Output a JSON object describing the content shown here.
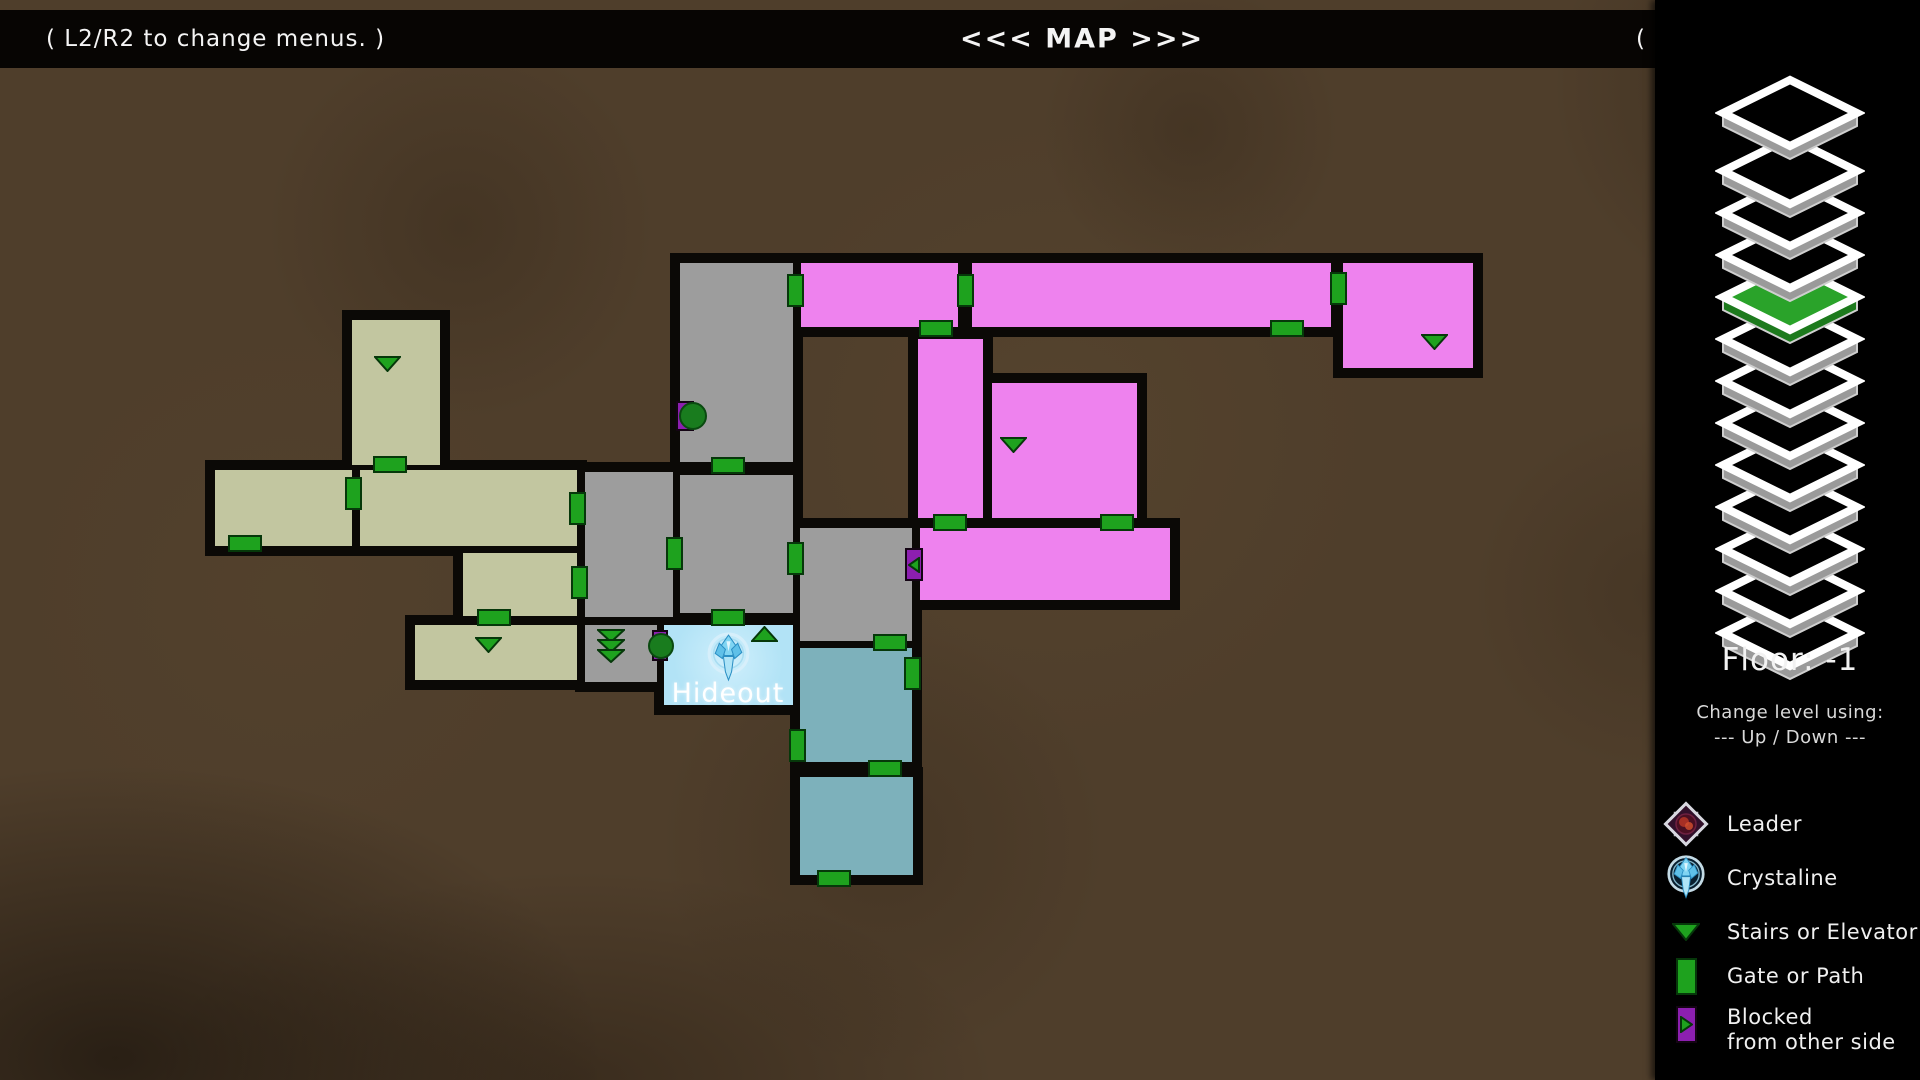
{
  "topbar": {
    "left_hint": "( L2/R2 to change menus. )",
    "title": "<<< MAP >>>",
    "right_hint": "( SELECT to exit. )"
  },
  "sidebar": {
    "floor_label": "Floor: -1",
    "change_hint": "Change level using:",
    "updown_hint": "--- Up / Down ---",
    "floor_stack": {
      "count": 13,
      "active_from_top": 5,
      "active_color": "#2aa32a"
    },
    "legend": [
      {
        "icon": "leader-icon",
        "label": "Leader"
      },
      {
        "icon": "crystaline-icon",
        "label": "Crystaline"
      },
      {
        "icon": "stairs-icon",
        "label": "Stairs or Elevator"
      },
      {
        "icon": "gate-icon",
        "label": "Gate or Path"
      },
      {
        "icon": "blocked-icon",
        "label": "Blocked",
        "label2": "from other side"
      }
    ]
  },
  "map": {
    "hideout_label": "Hideout",
    "colors": {
      "gray": "#9d9d9d",
      "olive": "#c2c6a0",
      "magenta": "#ee82ee",
      "teal": "#7db1bb",
      "hideout": "#b6e6f7",
      "gate_green": "#1ea21e",
      "marker_purple": "#8c1fb0",
      "dot_green": "#197c1e",
      "wall_black": "#0b0906",
      "background_brown": "#4f3e2b"
    },
    "rooms": [
      {
        "name": "stair-column-upper",
        "color": "gray",
        "x": 680,
        "y": 263,
        "w": 113,
        "h": 199
      },
      {
        "name": "stair-column-lower",
        "color": "gray",
        "x": 680,
        "y": 475,
        "w": 113,
        "h": 138
      },
      {
        "name": "center-gray-room",
        "color": "gray",
        "x": 585,
        "y": 472,
        "w": 88,
        "h": 145
      },
      {
        "name": "arrows-room",
        "color": "gray",
        "x": 585,
        "y": 625,
        "w": 72,
        "h": 57
      },
      {
        "name": "east-gray-room",
        "color": "gray",
        "x": 800,
        "y": 528,
        "w": 112,
        "h": 113
      },
      {
        "name": "olive-tower",
        "color": "olive",
        "x": 352,
        "y": 320,
        "w": 88,
        "h": 145
      },
      {
        "name": "olive-west-hall",
        "color": "olive",
        "x": 215,
        "y": 470,
        "w": 137,
        "h": 76
      },
      {
        "name": "olive-main-hall",
        "color": "olive",
        "x": 360,
        "y": 470,
        "w": 217,
        "h": 76
      },
      {
        "name": "olive-mid-room",
        "color": "olive",
        "x": 463,
        "y": 553,
        "w": 114,
        "h": 63
      },
      {
        "name": "olive-south-room",
        "color": "olive",
        "x": 415,
        "y": 625,
        "w": 162,
        "h": 55
      },
      {
        "name": "magenta-nw-room",
        "color": "magenta",
        "x": 801,
        "y": 263,
        "w": 157,
        "h": 64
      },
      {
        "name": "magenta-corridor",
        "color": "magenta",
        "x": 972,
        "y": 263,
        "w": 359,
        "h": 64
      },
      {
        "name": "magenta-ne-room",
        "color": "magenta",
        "x": 1343,
        "y": 263,
        "w": 130,
        "h": 105
      },
      {
        "name": "magenta-strip",
        "color": "magenta",
        "x": 918,
        "y": 339,
        "w": 65,
        "h": 179
      },
      {
        "name": "magenta-square",
        "color": "magenta",
        "x": 992,
        "y": 383,
        "w": 145,
        "h": 135
      },
      {
        "name": "magenta-wide-room",
        "color": "magenta",
        "x": 920,
        "y": 528,
        "w": 250,
        "h": 72
      },
      {
        "name": "teal-upper-room",
        "color": "teal",
        "x": 800,
        "y": 648,
        "w": 112,
        "h": 114
      },
      {
        "name": "teal-lower-room",
        "color": "teal",
        "x": 800,
        "y": 777,
        "w": 113,
        "h": 98
      },
      {
        "name": "hideout",
        "color": "hideout",
        "x": 664,
        "y": 625,
        "w": 129,
        "h": 80
      }
    ],
    "gates": [
      {
        "x": 787,
        "y": 274,
        "w": 17,
        "h": 33
      },
      {
        "x": 957,
        "y": 274,
        "w": 17,
        "h": 33
      },
      {
        "x": 1330,
        "y": 272,
        "w": 17,
        "h": 33
      },
      {
        "x": 569,
        "y": 492,
        "w": 17,
        "h": 33
      },
      {
        "x": 571,
        "y": 566,
        "w": 17,
        "h": 33
      },
      {
        "x": 666,
        "y": 537,
        "w": 17,
        "h": 33
      },
      {
        "x": 787,
        "y": 542,
        "w": 17,
        "h": 33
      },
      {
        "x": 345,
        "y": 477,
        "w": 17,
        "h": 33
      },
      {
        "x": 904,
        "y": 657,
        "w": 17,
        "h": 33
      },
      {
        "x": 789,
        "y": 729,
        "w": 17,
        "h": 33
      },
      {
        "x": 919,
        "y": 320,
        "w": 34,
        "h": 17
      },
      {
        "x": 1270,
        "y": 320,
        "w": 34,
        "h": 17
      },
      {
        "x": 933,
        "y": 514,
        "w": 34,
        "h": 17
      },
      {
        "x": 1100,
        "y": 514,
        "w": 34,
        "h": 17
      },
      {
        "x": 711,
        "y": 457,
        "w": 34,
        "h": 17
      },
      {
        "x": 373,
        "y": 456,
        "w": 34,
        "h": 17
      },
      {
        "x": 228,
        "y": 535,
        "w": 34,
        "h": 17
      },
      {
        "x": 477,
        "y": 609,
        "w": 34,
        "h": 17
      },
      {
        "x": 711,
        "y": 609,
        "w": 34,
        "h": 17
      },
      {
        "x": 873,
        "y": 634,
        "w": 34,
        "h": 17
      },
      {
        "x": 868,
        "y": 760,
        "w": 34,
        "h": 17
      },
      {
        "x": 817,
        "y": 870,
        "w": 34,
        "h": 17
      }
    ],
    "stairs": [
      {
        "x": 374,
        "y": 356,
        "dir": "down"
      },
      {
        "x": 475,
        "y": 637,
        "dir": "down"
      },
      {
        "x": 1000,
        "y": 437,
        "dir": "down"
      },
      {
        "x": 1421,
        "y": 334,
        "dir": "down"
      },
      {
        "x": 751,
        "y": 626,
        "dir": "up"
      },
      {
        "x": 597,
        "y": 629,
        "dir": "down3"
      }
    ],
    "blocked": [
      {
        "x": 905,
        "y": 548,
        "w": 18,
        "h": 33,
        "dir": "left"
      }
    ],
    "dots": [
      {
        "rect": [
          676,
          401,
          18,
          30
        ],
        "circle": [
          693,
          416,
          14
        ]
      },
      {
        "rect": [
          652,
          630,
          16,
          31
        ],
        "circle": [
          661,
          646,
          13
        ]
      }
    ],
    "crystal": {
      "x": 706,
      "y": 631,
      "size": 45
    },
    "hideout_label_pos": {
      "x": 728,
      "y": 678
    }
  }
}
